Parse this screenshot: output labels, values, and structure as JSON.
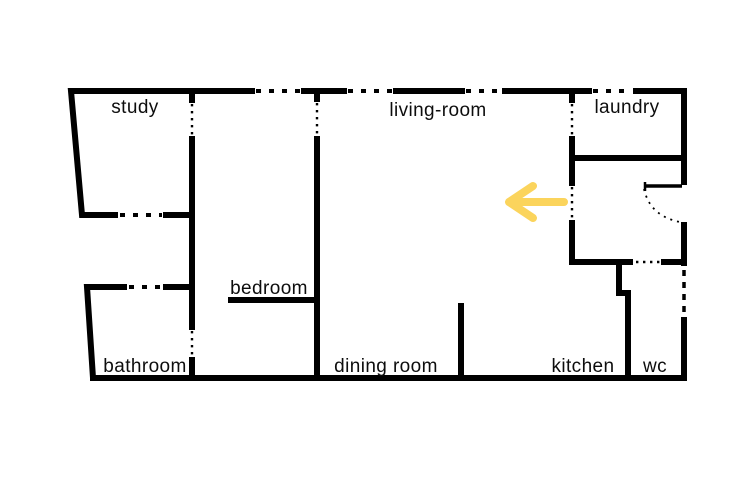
{
  "scene": {
    "type": "apartment-floor-plan",
    "background": "#ffffff",
    "wall_color": "#000000",
    "text_color": "#0d0d0d"
  },
  "rooms": [
    {
      "name": "study",
      "label": "study"
    },
    {
      "name": "living-room",
      "label": "living-room"
    },
    {
      "name": "laundry",
      "label": "laundry"
    },
    {
      "name": "bedroom",
      "label": "bedroom"
    },
    {
      "name": "bathroom",
      "label": "bathroom"
    },
    {
      "name": "dining-room",
      "label": "dining room"
    },
    {
      "name": "kitchen",
      "label": "kitchen"
    },
    {
      "name": "wc",
      "label": "wc"
    }
  ],
  "arrow": {
    "direction": "left",
    "color": "#FBD45C"
  }
}
